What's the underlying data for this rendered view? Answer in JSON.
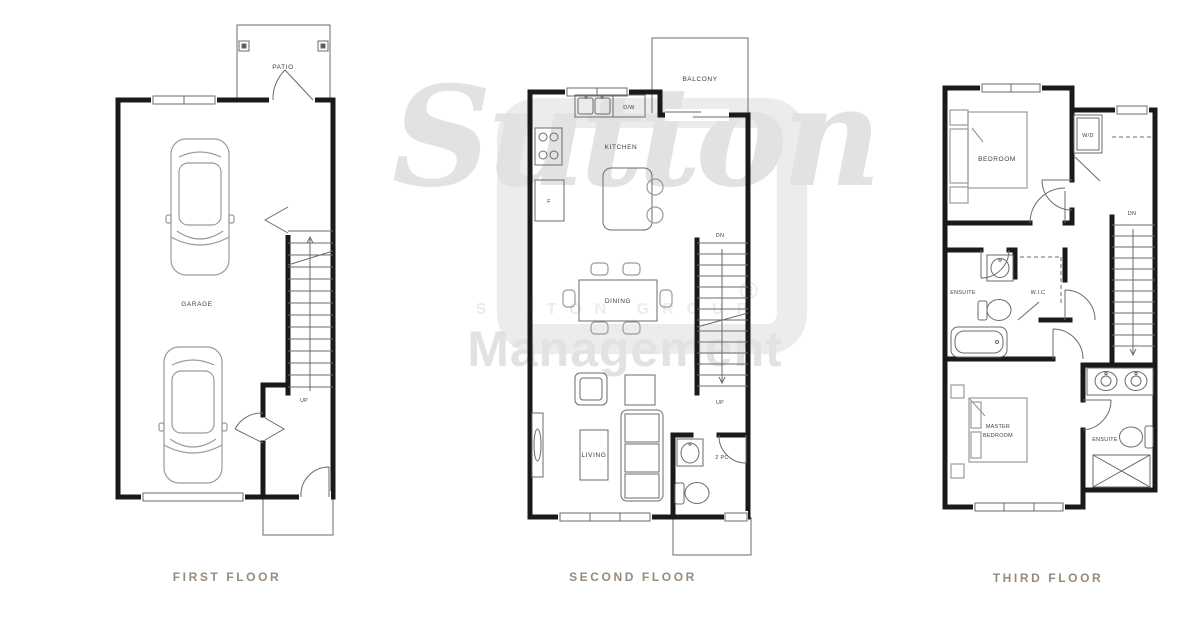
{
  "watermark": {
    "script": "Sutton",
    "registered": "®",
    "group_line": "SUTTON GROUP",
    "management": "Management"
  },
  "floors": [
    {
      "title": "FIRST FLOOR",
      "labels": {
        "patio": "PATIO",
        "garage": "GARAGE",
        "up": "UP"
      }
    },
    {
      "title": "SECOND FLOOR",
      "labels": {
        "balcony": "BALCONY",
        "kitchen": "KITCHEN",
        "dishwasher": "D/W",
        "fridge": "F",
        "dining": "DINING",
        "down": "DN",
        "up": "UP",
        "living": "LIVING",
        "powder_room": "2 PC"
      }
    },
    {
      "title": "THIRD FLOOR",
      "labels": {
        "bedroom": "BEDROOM",
        "washer_dryer": "W/D",
        "down": "DN",
        "ensuite": "ENSUITE",
        "walk_in_closet": "W.I.C",
        "master_bedroom_line1": "MASTER",
        "master_bedroom_line2": "BEDROOM",
        "master_ensuite": "ENSUITE"
      }
    }
  ],
  "colors": {
    "wall": "#1a1a1a",
    "thin": "#6b6b6b",
    "furniture": "#9a9a9a",
    "label": "#3d3d3d",
    "title": "#9a8a7a",
    "watermark": "#e4e2e0",
    "watermark_light": "#edecea",
    "background": "#ffffff"
  }
}
